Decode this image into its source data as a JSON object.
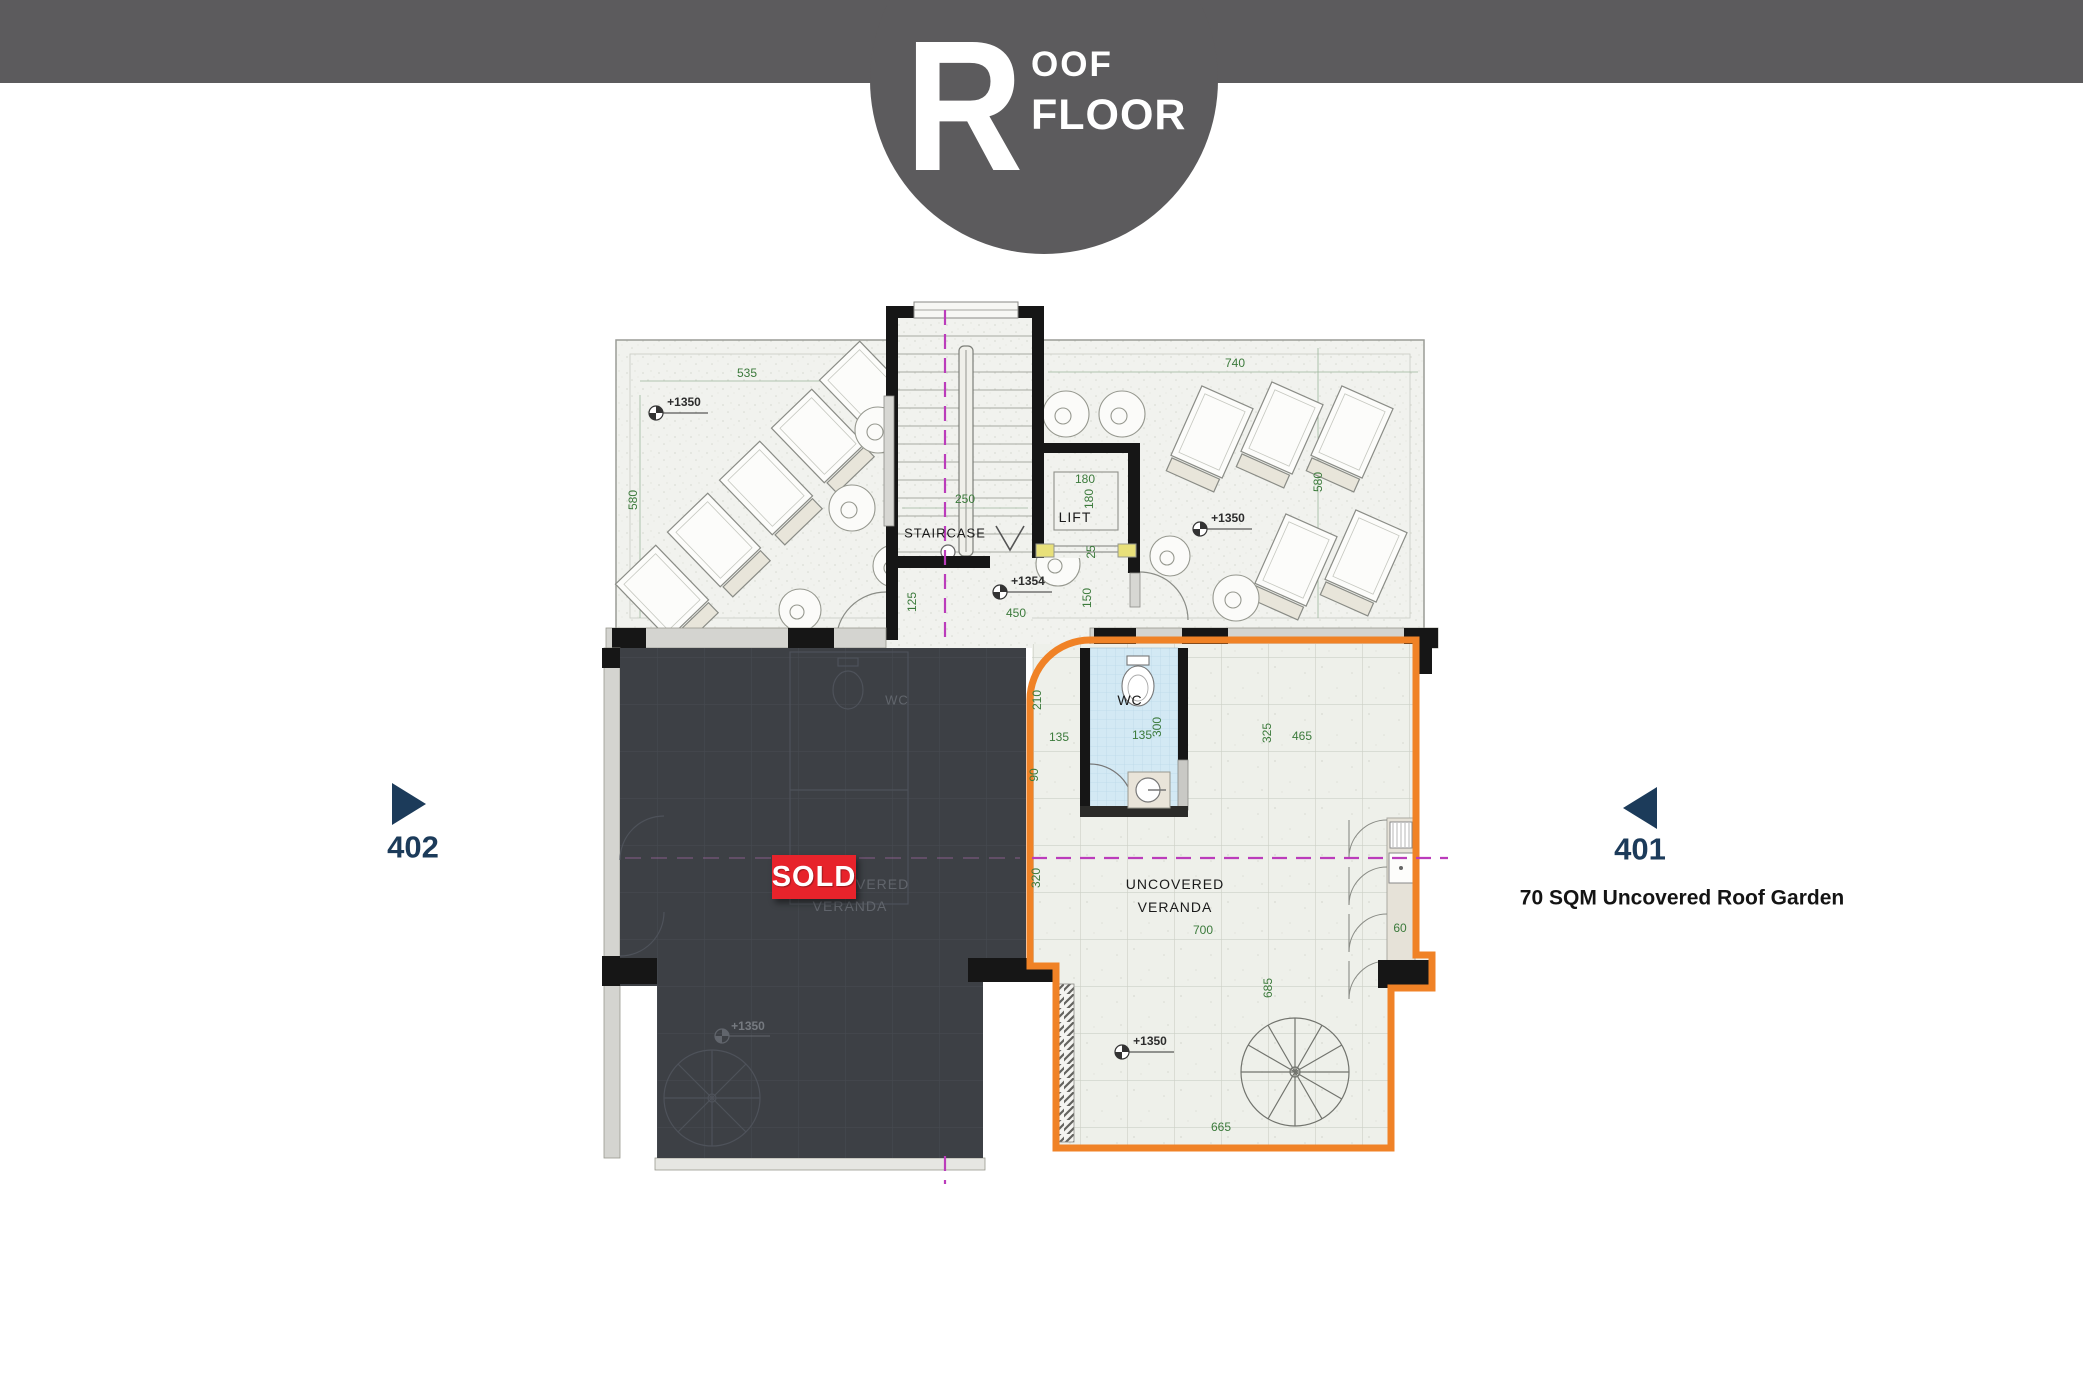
{
  "header": {
    "initial": "R",
    "title_rest": "OOF",
    "title_line2": "FLOOR"
  },
  "nav": {
    "unit_402": {
      "label": "402"
    },
    "unit_401": {
      "label": "401",
      "subtitle": "70 SQM Uncovered Roof Garden"
    }
  },
  "badges": {
    "sold": "SOLD"
  },
  "rooms": {
    "staircase": "STAIRCASE",
    "lift": "LIFT",
    "wc": "WC",
    "veranda_line1": "UNCOVERED",
    "veranda_line2": "VERANDA",
    "wc_sold": "WC",
    "veranda_sold_line1": "UNCOVERED",
    "veranda_sold_line2": "VERANDA"
  },
  "levels": {
    "terrace_left": "+1350",
    "terrace_right": "+1350",
    "landing": "+1354",
    "veranda_401": "+1350",
    "veranda_402": "+1350"
  },
  "dims": {
    "terrace_top_left": "535",
    "terrace_top_right": "740",
    "terrace_left": "580",
    "terrace_right": "580",
    "stair_width": "250",
    "lift_width": "180",
    "lift_depth": "180",
    "lift_door": "25",
    "landing_depth": "150",
    "stair_side": "125",
    "landing_width": "450",
    "wc_offset": "135",
    "wc_width": "135",
    "wc_depth": "300",
    "veranda_325": "325",
    "veranda_465": "465",
    "edge_210": "210",
    "edge_90": "90",
    "edge_320": "320",
    "veranda_width": "700",
    "kitchen_60": "60",
    "veranda_depth": "685",
    "veranda_bottom": "665"
  },
  "colors": {
    "header_gray": "#5c5b5d",
    "accent_orange": "#f08226",
    "sold_red": "#e7232b",
    "label_navy": "#1c3b5a",
    "dim_green": "#3b7a3b",
    "axis_magenta": "#bb3cbb",
    "unit_dark": "#3d4045",
    "wc_blue": "#d3e9f4"
  }
}
